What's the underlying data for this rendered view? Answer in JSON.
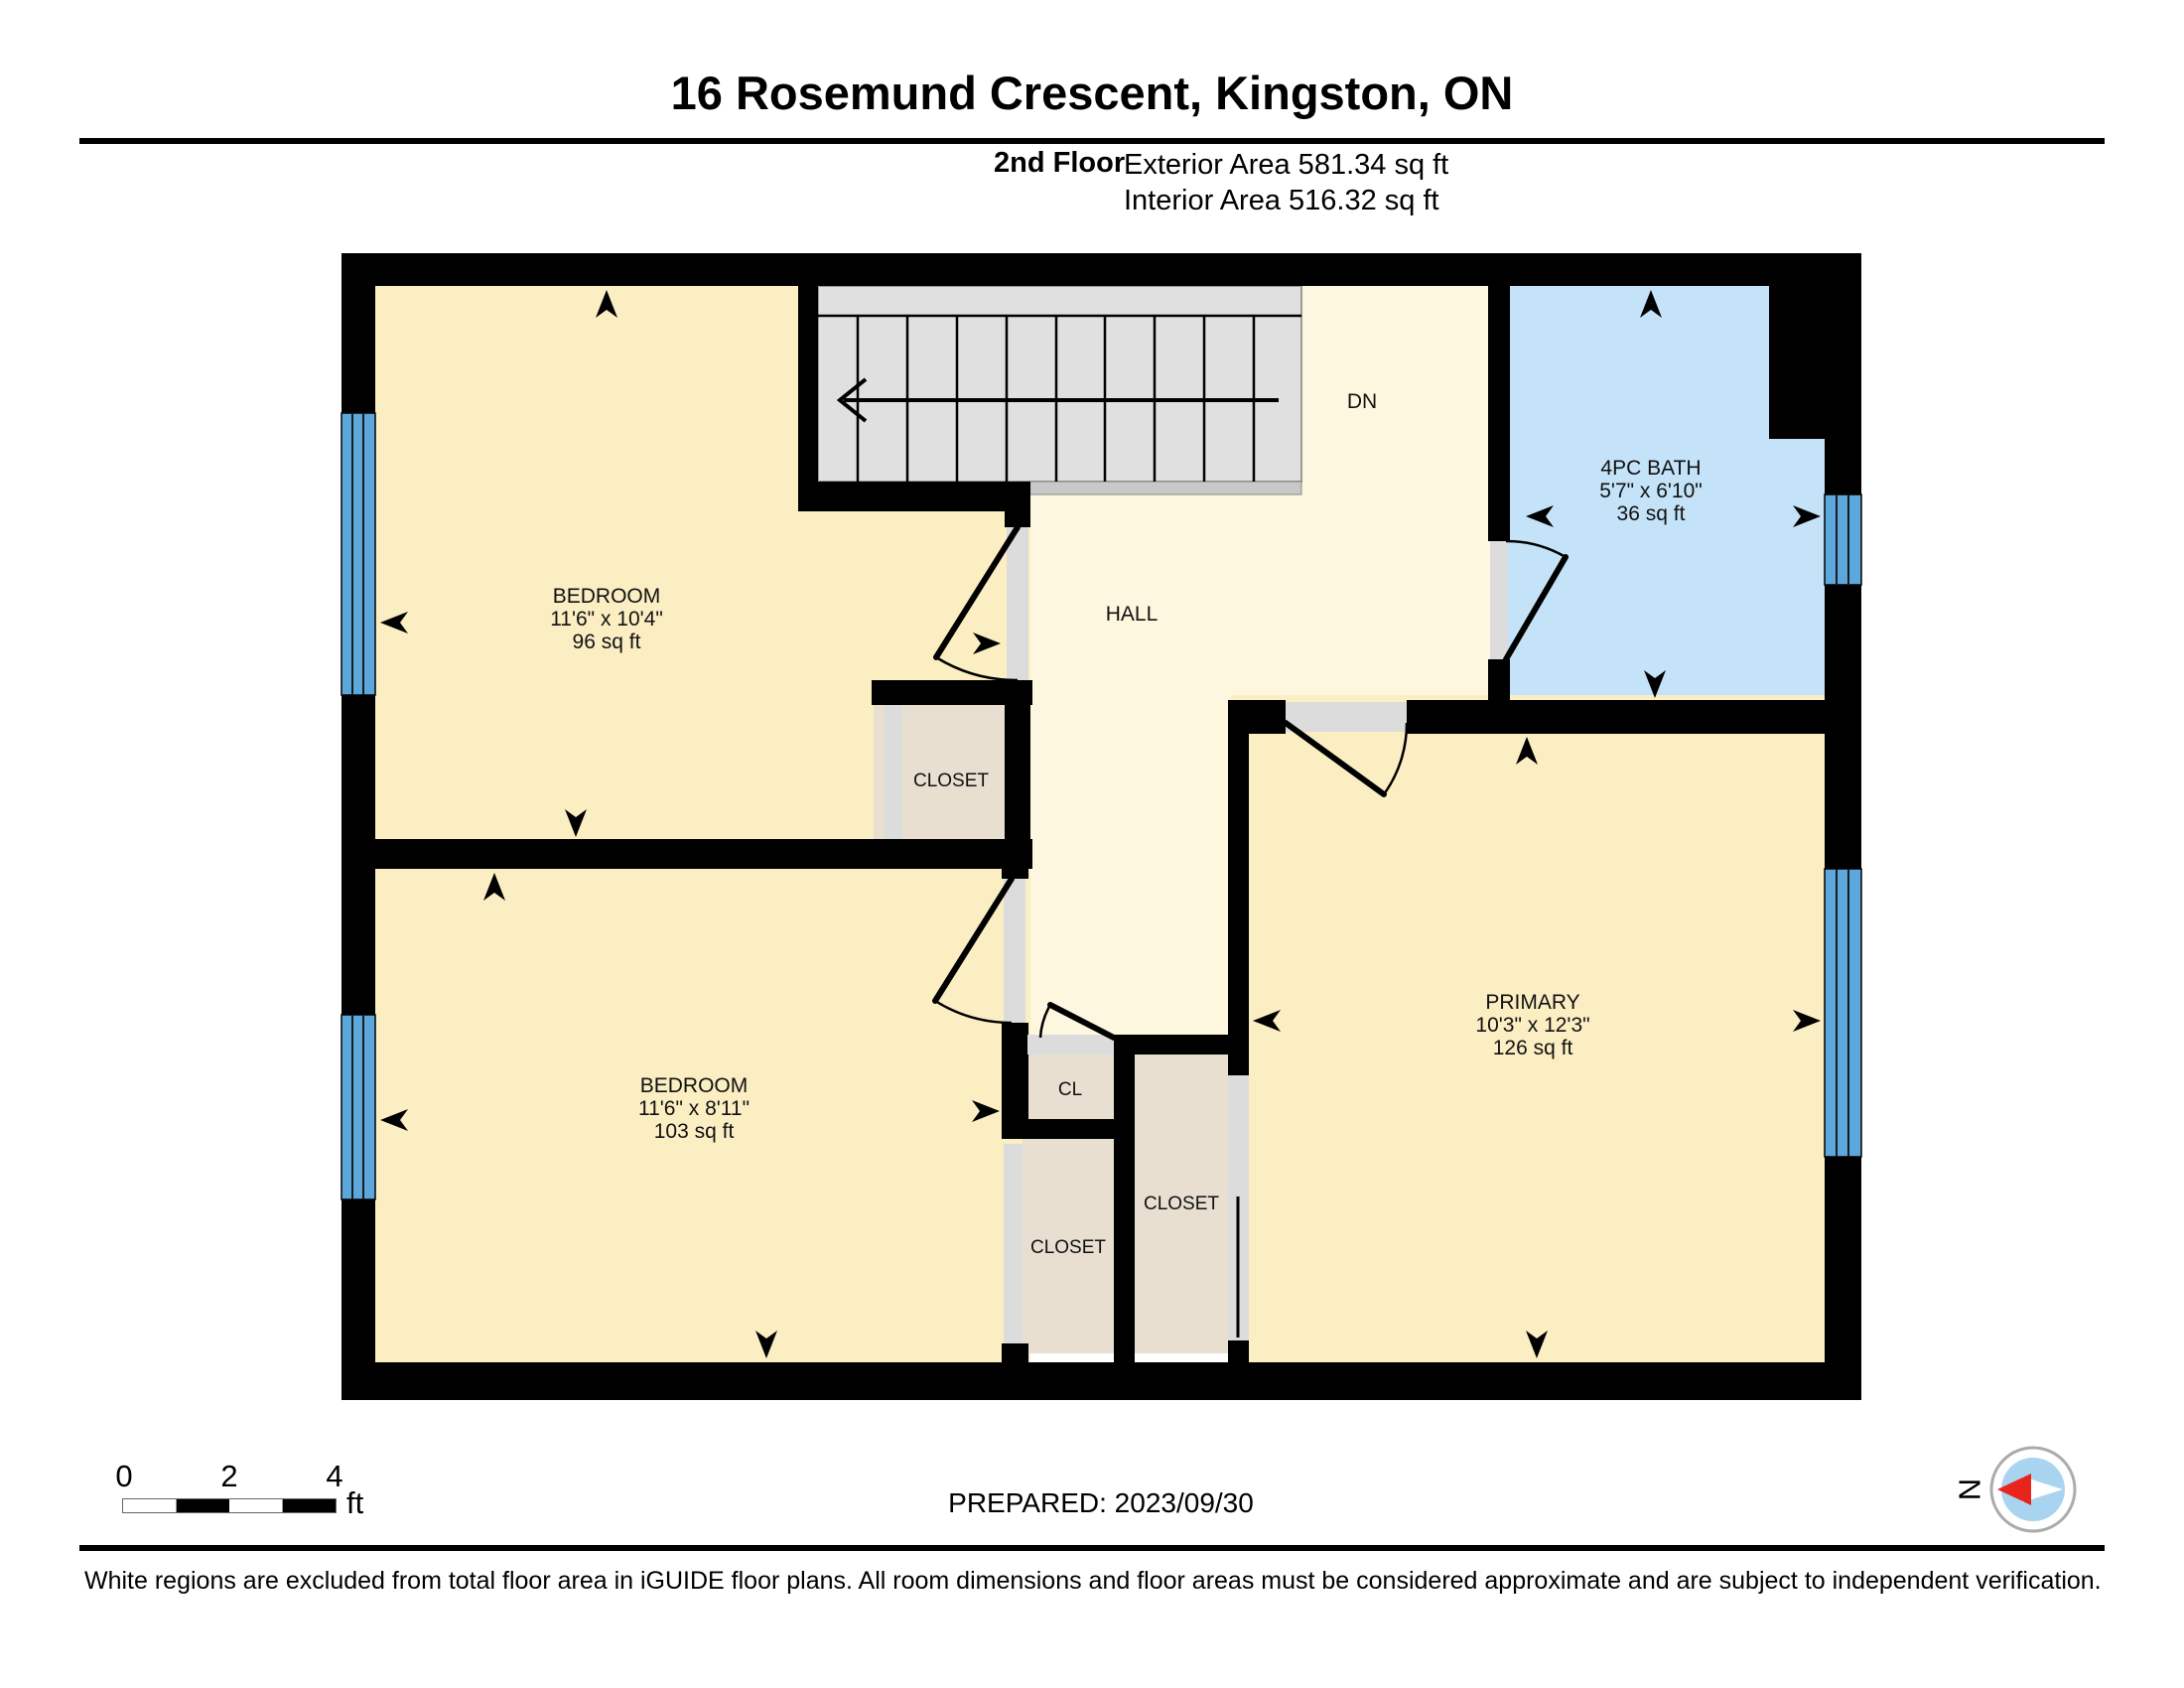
{
  "header": {
    "title": "16 Rosemund Crescent, Kingston, ON",
    "floor_label": "2nd Floor",
    "exterior_area": "Exterior Area 581.34 sq ft",
    "interior_area": "Interior Area 516.32 sq ft"
  },
  "floorplan": {
    "rooms": {
      "bedroom_top": {
        "name": "BEDROOM",
        "dims": "11'6\" x 10'4\"",
        "area": "96 sq ft"
      },
      "bedroom_bottom": {
        "name": "BEDROOM",
        "dims": "11'6\" x 8'11\"",
        "area": "103 sq ft"
      },
      "primary": {
        "name": "PRIMARY",
        "dims": "10'3\" x 12'3\"",
        "area": "126 sq ft"
      },
      "bath": {
        "name": "4PC BATH",
        "dims": "5'7\" x 6'10\"",
        "area": "36 sq ft"
      },
      "hall": {
        "name": "HALL"
      },
      "closet_bedroom_top": {
        "name": "CLOSET"
      },
      "closet_small": {
        "name": "CL"
      },
      "closet_bedroom_bottom": {
        "name": "CLOSET"
      },
      "closet_primary": {
        "name": "CLOSET"
      },
      "stairs": {
        "label": "DN"
      }
    },
    "colors": {
      "room": "#FBEEC3",
      "hall": "#FEF7E0",
      "bath": "#C5E3F8",
      "closet": "#E8DFD1",
      "stairs": "#E0E0E0",
      "window": "#5CA8DD",
      "door_gap": "#DCDCDC",
      "wall": "#000000"
    }
  },
  "scale_bar": {
    "ticks": [
      "0",
      "2",
      "4"
    ],
    "unit": "ft"
  },
  "prepared_label": "PREPARED: 2023/09/30",
  "compass": {
    "label": "N",
    "needle_color": "#E8251D"
  },
  "footer_note": "White regions are excluded from total floor area in iGUIDE floor plans. All room dimensions and floor areas must be considered approximate and are subject to independent verification."
}
